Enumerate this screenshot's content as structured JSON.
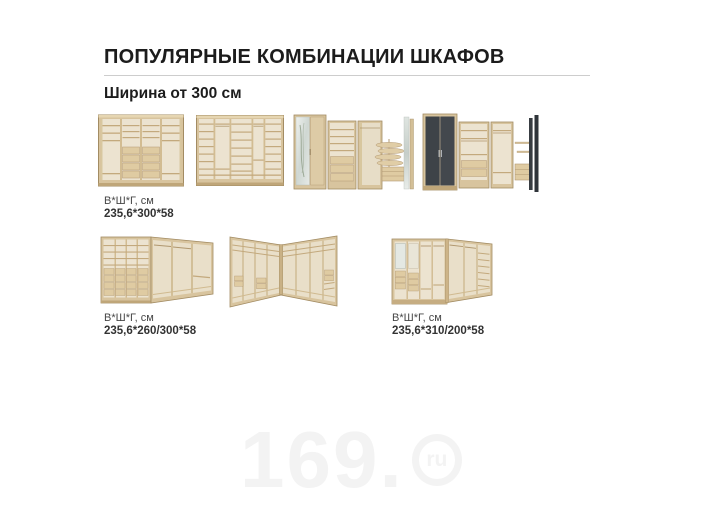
{
  "header": {
    "title": "ПОПУЛЯРНЫЕ КОМБИНАЦИИ ШКАФОВ",
    "subtitle": "Ширина от 300 см"
  },
  "catalog": {
    "row1_label": {
      "caption": "В*Ш*Г, см",
      "dims": "235,6*300*58"
    },
    "row2_label_left": {
      "caption": "В*Ш*Г, см",
      "dims": "235,6*260/300*58"
    },
    "row2_label_right": {
      "caption": "В*Ш*Г, см",
      "dims": "235,6*310/200*58"
    }
  },
  "watermark": {
    "prefix": "169.",
    "suffix": "ru"
  },
  "colors": {
    "oak_frame": "#d8c49e",
    "oak_interior": "#ece3d0",
    "shelf_line": "#c3a97d",
    "drawer_front": "#dfcba2",
    "dark_door": "#3e4348",
    "divider": "#cdcdcd",
    "text": "#1c1c1c",
    "watermark": "#f3f3f3"
  }
}
